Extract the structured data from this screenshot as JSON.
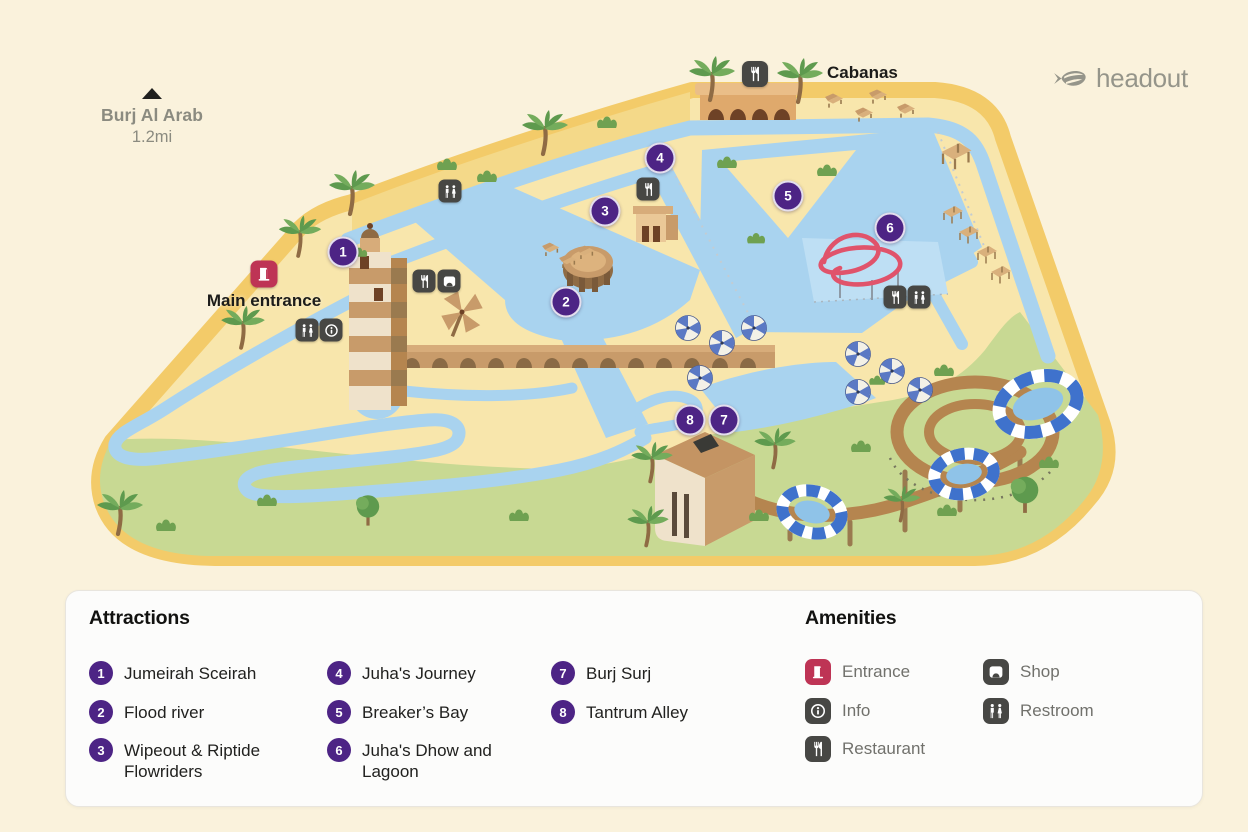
{
  "landmark": {
    "name": "Burj Al Arab",
    "distance": "1.2mi"
  },
  "logo": {
    "brand": "headout"
  },
  "map_labels": {
    "cabanas": "Cabanas",
    "main_entrance": "Main entrance"
  },
  "map_poi_icons": [
    "restroom-icon",
    "restaurant-icon",
    "shop-icon",
    "info-icon",
    "entrance-icon"
  ],
  "markers": [
    {
      "n": "1"
    },
    {
      "n": "2"
    },
    {
      "n": "3"
    },
    {
      "n": "4"
    },
    {
      "n": "5"
    },
    {
      "n": "6"
    },
    {
      "n": "7"
    },
    {
      "n": "8"
    }
  ],
  "legend": {
    "attractions": {
      "title": "Attractions",
      "items": [
        {
          "num": "1",
          "label": "Jumeirah Sceirah"
        },
        {
          "num": "2",
          "label": "Flood river"
        },
        {
          "num": "3",
          "label": "Wipeout & Riptide Flowriders"
        },
        {
          "num": "4",
          "label": "Juha's Journey"
        },
        {
          "num": "5",
          "label": "Breaker’s Bay"
        },
        {
          "num": "6",
          "label": "Juha's Dhow and Lagoon"
        },
        {
          "num": "7",
          "label": "Burj Surj"
        },
        {
          "num": "8",
          "label": "Tantrum Alley"
        }
      ]
    },
    "amenities": {
      "title": "Amenities",
      "items": [
        {
          "icon": "entrance-icon",
          "label": "Entrance"
        },
        {
          "icon": "info-icon",
          "label": "Info"
        },
        {
          "icon": "restaurant-icon",
          "label": "Restaurant"
        },
        {
          "icon": "shop-icon",
          "label": "Shop"
        },
        {
          "icon": "restroom-icon",
          "label": "Restroom"
        }
      ]
    }
  },
  "colors": {
    "background": "#FAF2DC",
    "island_border": "#F3CB69",
    "sand": "#F8E6AC",
    "water": "#A9D3EF",
    "grass": "#C8D993",
    "marker_purple": "#4D2485",
    "entrance_red": "#BE3455",
    "chip_dark": "#474744",
    "slide_red": "#E0536B",
    "funnel_blue": "#3F72CC"
  }
}
